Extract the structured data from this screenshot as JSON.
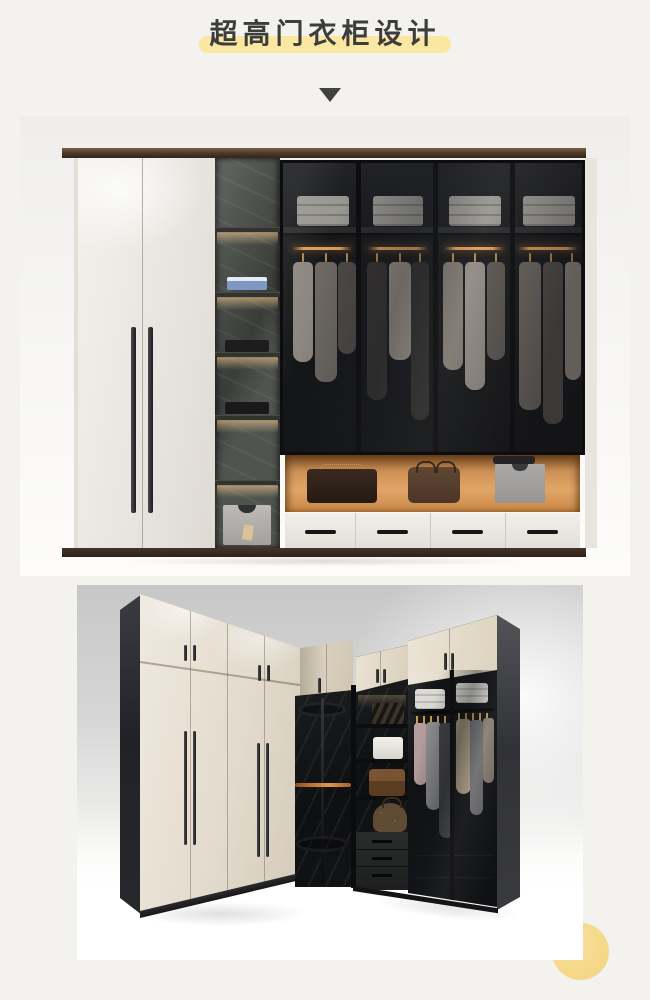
{
  "page": {
    "background_color": "#f3f2ef",
    "width": 650,
    "height": 1000
  },
  "header": {
    "title": "超高门衣柜设计",
    "title_color": "#3d3d3d",
    "highlight_color": "#f9e7a2",
    "marker_icon": "down-triangle-icon",
    "marker_color": "#414141"
  },
  "photos": [
    {
      "label": "flat-wall-tall-door-wardrobe-render",
      "palette": {
        "wood_trim": "#4a3726",
        "white_doors": "#ece9e3",
        "stone_shelving": "#50544f",
        "glass_doors": "#17181b",
        "led_light": "#ffd696",
        "display_niche_orange": "#cf9257",
        "drawer_front": "#eceae5"
      }
    },
    {
      "label": "l-shaped-corner-tall-door-wardrobe-render",
      "palette": {
        "cream_doors": "#e7e0d2",
        "carcass_black": "#222326",
        "interior_stone": "#141619",
        "hanger_gold": "#c49a4e",
        "rack_bar_orange": "#cf7f3a",
        "wall_gray": "#d2d2d2"
      }
    }
  ],
  "decor": {
    "corner_circle_color": "#f6d98a"
  }
}
